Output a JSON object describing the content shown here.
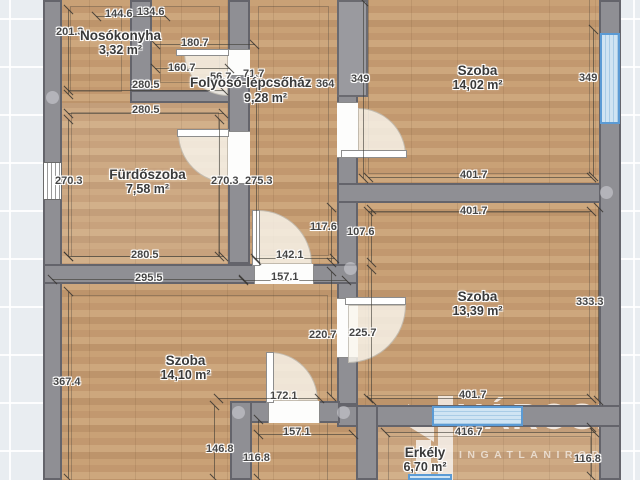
{
  "plan": {
    "rooms": [
      {
        "name": "Nosókonyha",
        "area": "3,32 m²"
      },
      {
        "name": "Folyosó-lépcsőház",
        "area": "9,28 m²"
      },
      {
        "name": "Szoba",
        "area": "14,02 m²"
      },
      {
        "name": "Fürdőszoba",
        "area": "7,58 m²"
      },
      {
        "name": "Szoba",
        "area": "13,39 m²"
      },
      {
        "name": "Szoba",
        "area": "14,10 m²"
      },
      {
        "name": "Erkély",
        "area": "6,70 m²"
      }
    ],
    "measurements": [
      "144.6",
      "134.6",
      "201.3",
      "180.7",
      "160.7",
      "56.7",
      "71.7",
      "364",
      "349",
      "280.5",
      "280.5",
      "349",
      "270.3",
      "270.3",
      "275.3",
      "401.7",
      "401.7",
      "117.6",
      "107.6",
      "142.1",
      "280.5",
      "157.1",
      "295.5",
      "333.3",
      "220.7",
      "225.7",
      "367.4",
      "401.7",
      "172.1",
      "416.7",
      "157.1",
      "146.8",
      "116.8",
      "116.8"
    ],
    "watermark": {
      "brand": "VÁROSI",
      "subtitle": "INGATLANIRODA"
    },
    "colors": {
      "wall": "#8f8f94",
      "window_frame": "#5b9bd5",
      "window_glass": "#cfe4f3",
      "floor": "#c49c72",
      "background": "#e9edf1"
    }
  }
}
